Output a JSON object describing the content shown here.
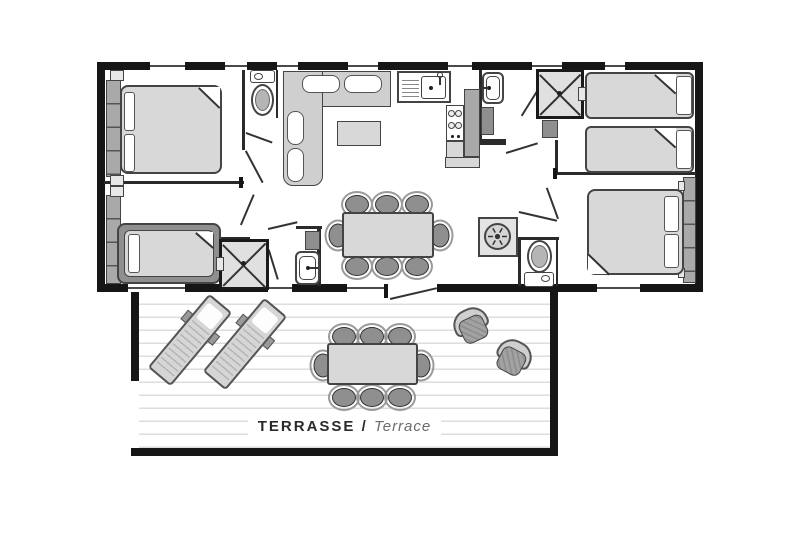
{
  "title": "floor-plan",
  "label": {
    "primary": "TERRASSE",
    "separator": " / ",
    "secondary": "Terrace"
  },
  "colors": {
    "wall": "#161616",
    "interior_wall": "#2a2a2a",
    "line": "#333333",
    "furniture_light": "#d8d8d8",
    "furniture_mid": "#a9a9a9",
    "furniture_dark": "#8f8f8f",
    "deck_line": "#dddddd",
    "background": "#ffffff"
  },
  "rooms": [
    "bedroom-double-left",
    "bedroom-single-left",
    "shower-room-left",
    "wc-front",
    "living-room",
    "kitchen",
    "bathroom-right",
    "shower-room-right",
    "bedroom-twin-right",
    "bedroom-double-right",
    "wc-right",
    "terrace"
  ],
  "furniture_icons": [
    "double-bed",
    "single-bed",
    "twin-beds",
    "wardrobe",
    "toilet",
    "shower-cabin",
    "washbasin",
    "corner-sofa",
    "coffee-table",
    "kitchen-sink",
    "stove",
    "fridge",
    "dining-table-8-chairs",
    "water-heater-fan",
    "sun-lounger",
    "outdoor-armchair",
    "terrace-dining-table-8-chairs"
  ]
}
